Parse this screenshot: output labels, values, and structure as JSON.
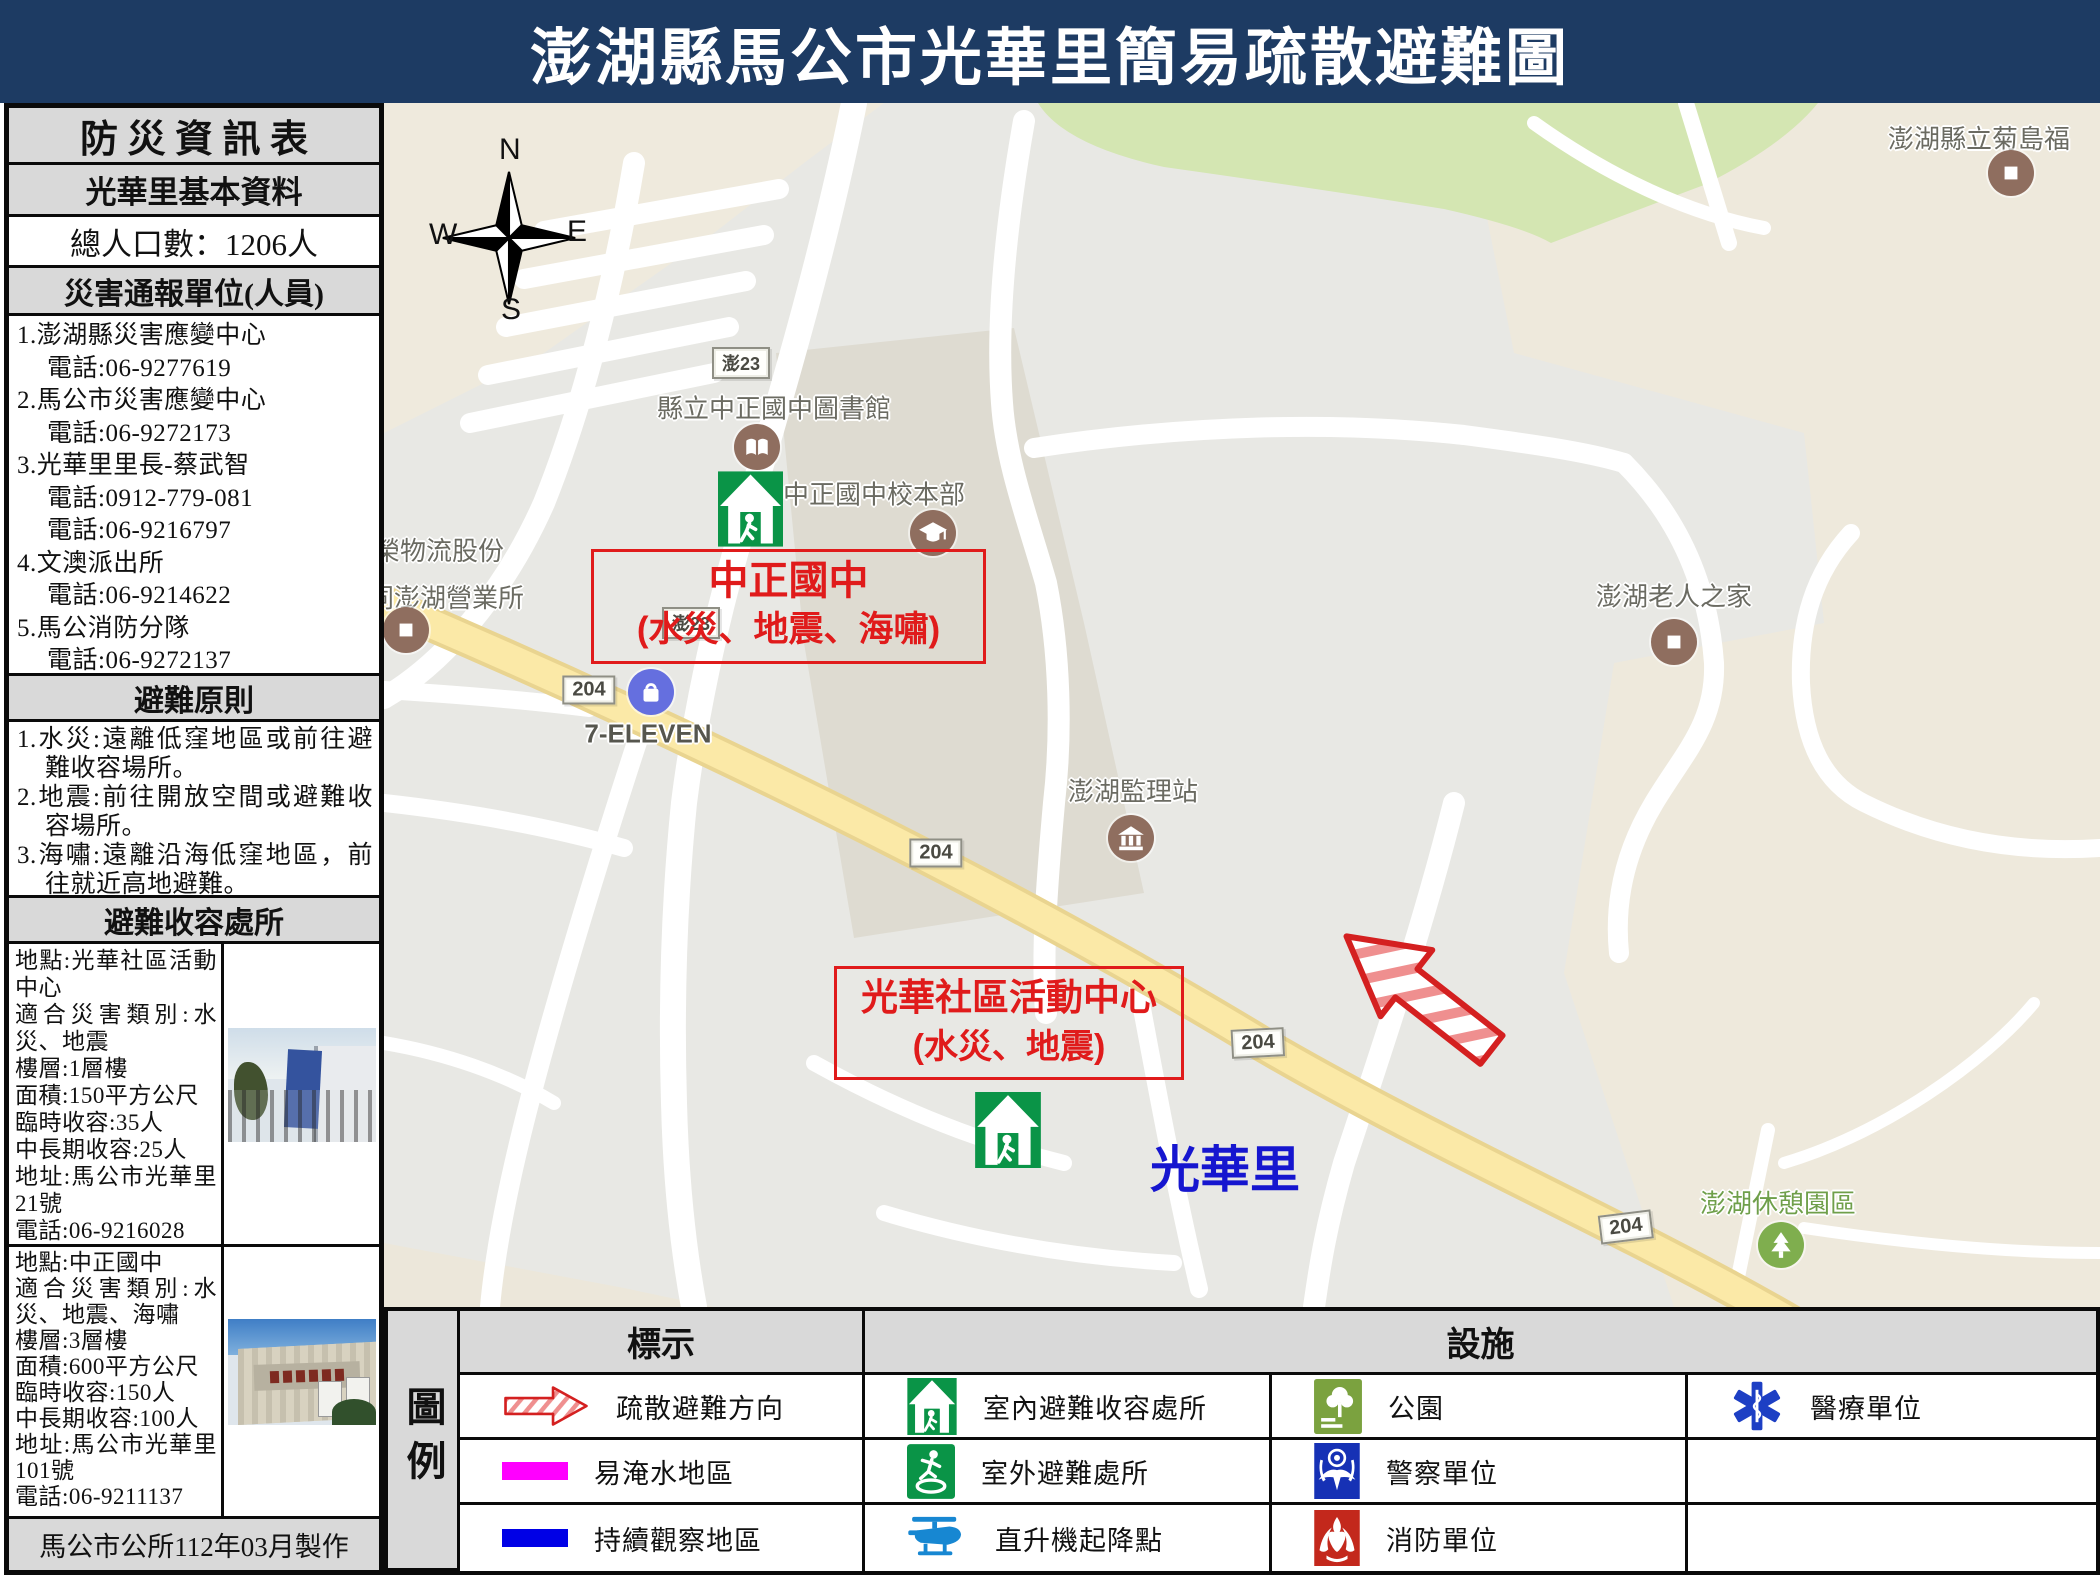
{
  "title": "澎湖縣馬公市光華里簡易疏散避難圖",
  "sidebar": {
    "header": "防 災 資 訊 表",
    "basic_header": "光華里基本資料",
    "population": "總人口數：1206人",
    "units_header": "災害通報單位(人員)",
    "unit_lines": [
      "1.澎湖縣災害應變中心",
      "電話:06-9277619",
      "2.馬公市災害應變中心",
      "電話:06-9272173",
      "3.光華里里長-蔡武智",
      "電話:0912-779-081",
      "電話:06-9216797",
      "4.文澳派出所",
      "電話:06-9214622",
      "5.馬公消防分隊",
      "電話:06-9272137"
    ],
    "principles_header": "避難原則",
    "principles": [
      "1.水災:遠離低窪地區或前往避難收容場所。",
      "2.地震:前往開放空間或避難收容場所。",
      "3.海嘯:遠離沿海低窪地區，前往就近高地避難。"
    ],
    "shelters_header": "避難收容處所",
    "shelter1": {
      "fields": [
        "地點:光華社區活動中心",
        "適合災害類別:水災、地震",
        "樓層:1層樓",
        "面積:150平方公尺",
        "臨時收容:35人",
        "中長期收容:25人",
        "地址:馬公市光華里21號",
        "電話:06-9216028"
      ]
    },
    "shelter2": {
      "fields": [
        "地點:中正國中",
        "適合災害類別:水災、地震、海嘯",
        "樓層:3層樓",
        "面積:600平方公尺",
        "臨時收容:150人",
        "中長期收容:100人",
        "地址:馬公市光華里101號",
        "電話:06-9211137"
      ]
    },
    "footer": "馬公市公所112年03月製作"
  },
  "map": {
    "compass": {
      "n": "N",
      "e": "E",
      "s": "S",
      "w": "W"
    },
    "signs": {
      "peng23": "澎23",
      "r204": "204"
    },
    "labels": {
      "library": "縣立中正國中圖書館",
      "school": "中正國中校本部",
      "logistics1": "榮物流股份",
      "logistics2": "同澎湖營業所",
      "seven": "7-ELEVEN",
      "dmv": "澎湖監理站",
      "elder": "澎湖老人之家",
      "welfare": "澎湖縣立菊島福",
      "rest": "澎湖休憩園區",
      "village": "光華里"
    },
    "callout1": {
      "title": "中正國中",
      "subtitle": "(水災、地震、海嘯)"
    },
    "callout2": {
      "title": "光華社區活動中心",
      "subtitle": "(水災、地震)"
    }
  },
  "legend": {
    "title": "圖例",
    "marks_header": "標示",
    "facilities_header": "設施",
    "marks": [
      {
        "icon": "evacuation-arrow",
        "label": "疏散避難方向",
        "color": "#e01b1b"
      },
      {
        "icon": "flood-area-chip",
        "label": "易淹水地區",
        "color": "#ff00ff"
      },
      {
        "icon": "watch-area-chip",
        "label": "持續觀察地區",
        "color": "#0000e6"
      }
    ],
    "facilities": [
      {
        "icon": "indoor-shelter",
        "label": "室內避難收容處所",
        "color": "#0a9447"
      },
      {
        "icon": "outdoor-shelter",
        "label": "室外避難處所",
        "color": "#0a9447"
      },
      {
        "icon": "heliport",
        "label": "直升機起降點",
        "color": "#1787d2"
      },
      {
        "icon": "park",
        "label": "公園",
        "color": "#7ba23f"
      },
      {
        "icon": "police",
        "label": "警察單位",
        "color": "#1631b5"
      },
      {
        "icon": "fire",
        "label": "消防單位",
        "color": "#c3281c"
      },
      {
        "icon": "medical",
        "label": "醫療單位",
        "color": "#1d3fc4"
      }
    ]
  },
  "colors": {
    "title_navy": "#1d3b63",
    "callout_red": "#e01b1b",
    "shelter_green": "#0a9447",
    "village_blue": "#1616cf",
    "road_yellow": "#fbe9a7"
  }
}
